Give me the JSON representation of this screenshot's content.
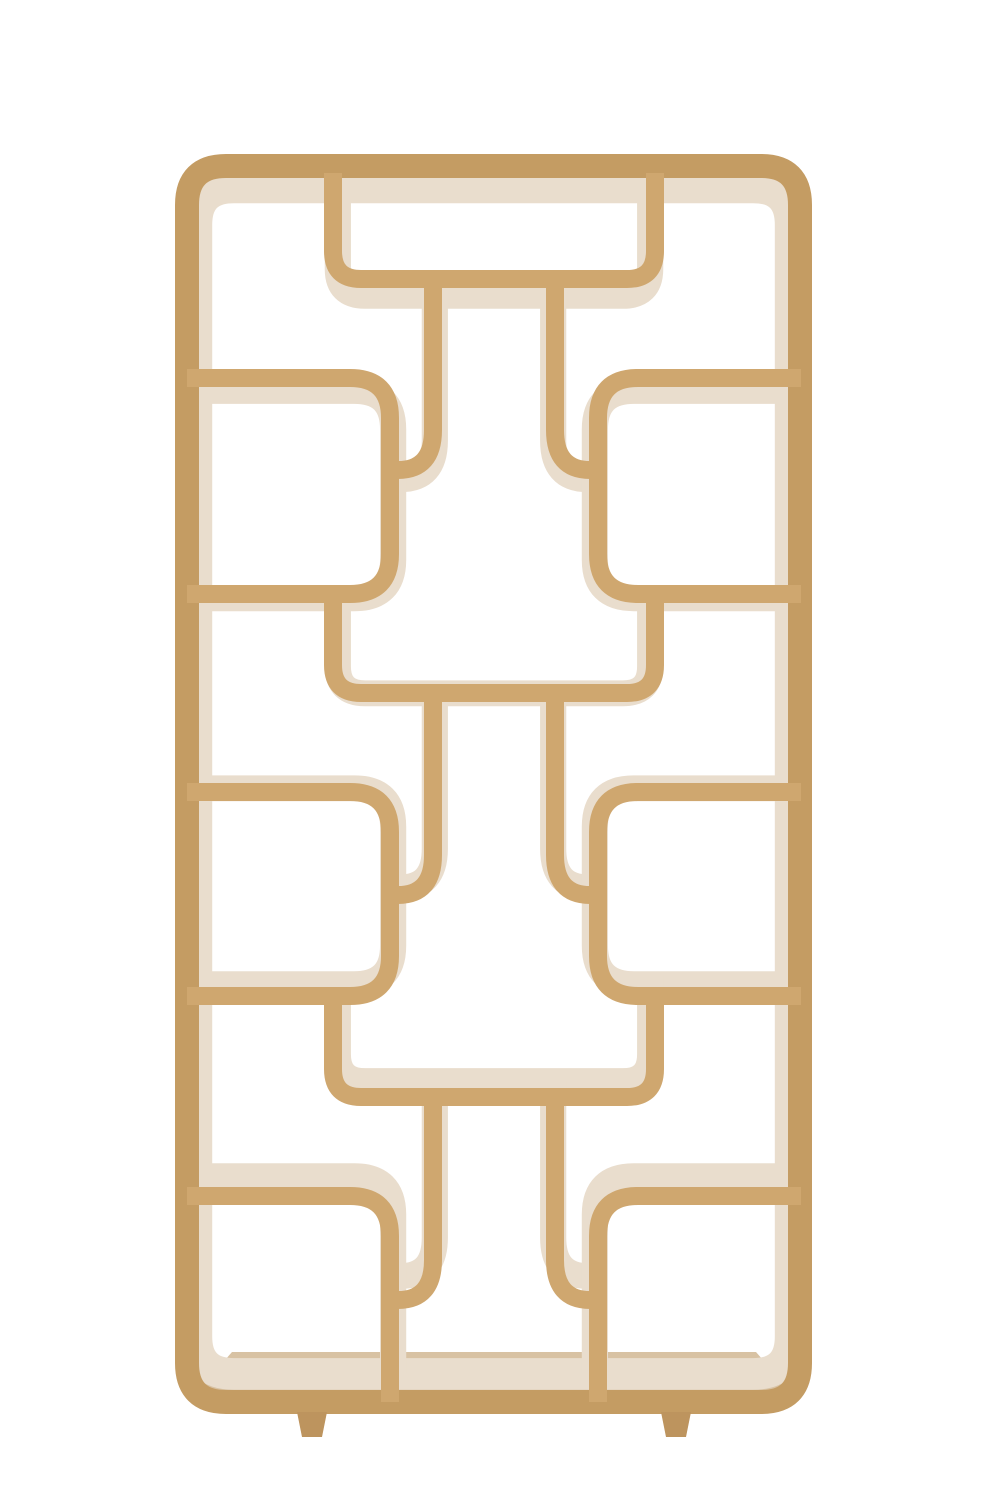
{
  "scene": {
    "alt_text": "Natural mango-wood curved room divider etagere with rounded rectangular frame, interlocking S-curve shelves forming open display nooks, whitewashed inner faces, two tapered feet, on plain white background"
  },
  "colors": {
    "background": "#ffffff",
    "wood_front": "#cfa76f",
    "wood_front_deep": "#c49c63",
    "wood_wash": "#e9ddcd",
    "floor_top": "#d8c2a3",
    "floor_grain": "#c9af8a",
    "feet": "#bd945e"
  },
  "geometry": {
    "canvas": {
      "w": 1000,
      "h": 1500
    },
    "frame": {
      "x1": 187,
      "y1": 166,
      "x2": 800,
      "y2": 1402,
      "r": 39,
      "stroke": 24
    },
    "member_stroke": 18,
    "pale_extra": 9,
    "pale_scale": {
      "sx": 0.97,
      "sy": 0.96,
      "ox": 494,
      "oy": 700
    },
    "columns": {
      "tray_left": 333,
      "tray_right": 655,
      "side_left": 390,
      "side_right": 598,
      "post_left": 433,
      "post_right": 555,
      "shelf_end_left": 350,
      "shelf_end_right": 638,
      "frame_inner_left": 187,
      "frame_inner_right": 801
    },
    "radii": {
      "tray": 28,
      "side": 40,
      "post": 40,
      "post_reach": 35
    },
    "rows": [
      {
        "anchor": 173,
        "tray": 279,
        "junction": 470,
        "side_top": 378,
        "shelf_below": 594,
        "floor": null
      },
      {
        "anchor": 585,
        "tray": 693,
        "junction": 895,
        "side_top": 792,
        "shelf_below": 996,
        "floor": null
      },
      {
        "anchor": 987,
        "tray": 1097,
        "junction": 1300,
        "side_top": 1196,
        "shelf_below": null,
        "floor": 1402
      }
    ],
    "floor_surface": {
      "pts": [
        [
          232,
          1352
        ],
        [
          756,
          1352
        ],
        [
          790,
          1391
        ],
        [
          198,
          1391
        ]
      ]
    },
    "floor_grain_lines": [
      {
        "d": "M 240 1372 L 750 1368"
      },
      {
        "d": "M 215 1386 L 780 1384"
      }
    ],
    "feet": [
      {
        "name": "foot-left",
        "pts": [
          [
            297,
            1412
          ],
          [
            327,
            1412
          ],
          [
            322,
            1437
          ],
          [
            302,
            1437
          ]
        ]
      },
      {
        "name": "foot-right",
        "pts": [
          [
            661,
            1412
          ],
          [
            691,
            1412
          ],
          [
            686,
            1437
          ],
          [
            666,
            1437
          ]
        ]
      }
    ]
  }
}
